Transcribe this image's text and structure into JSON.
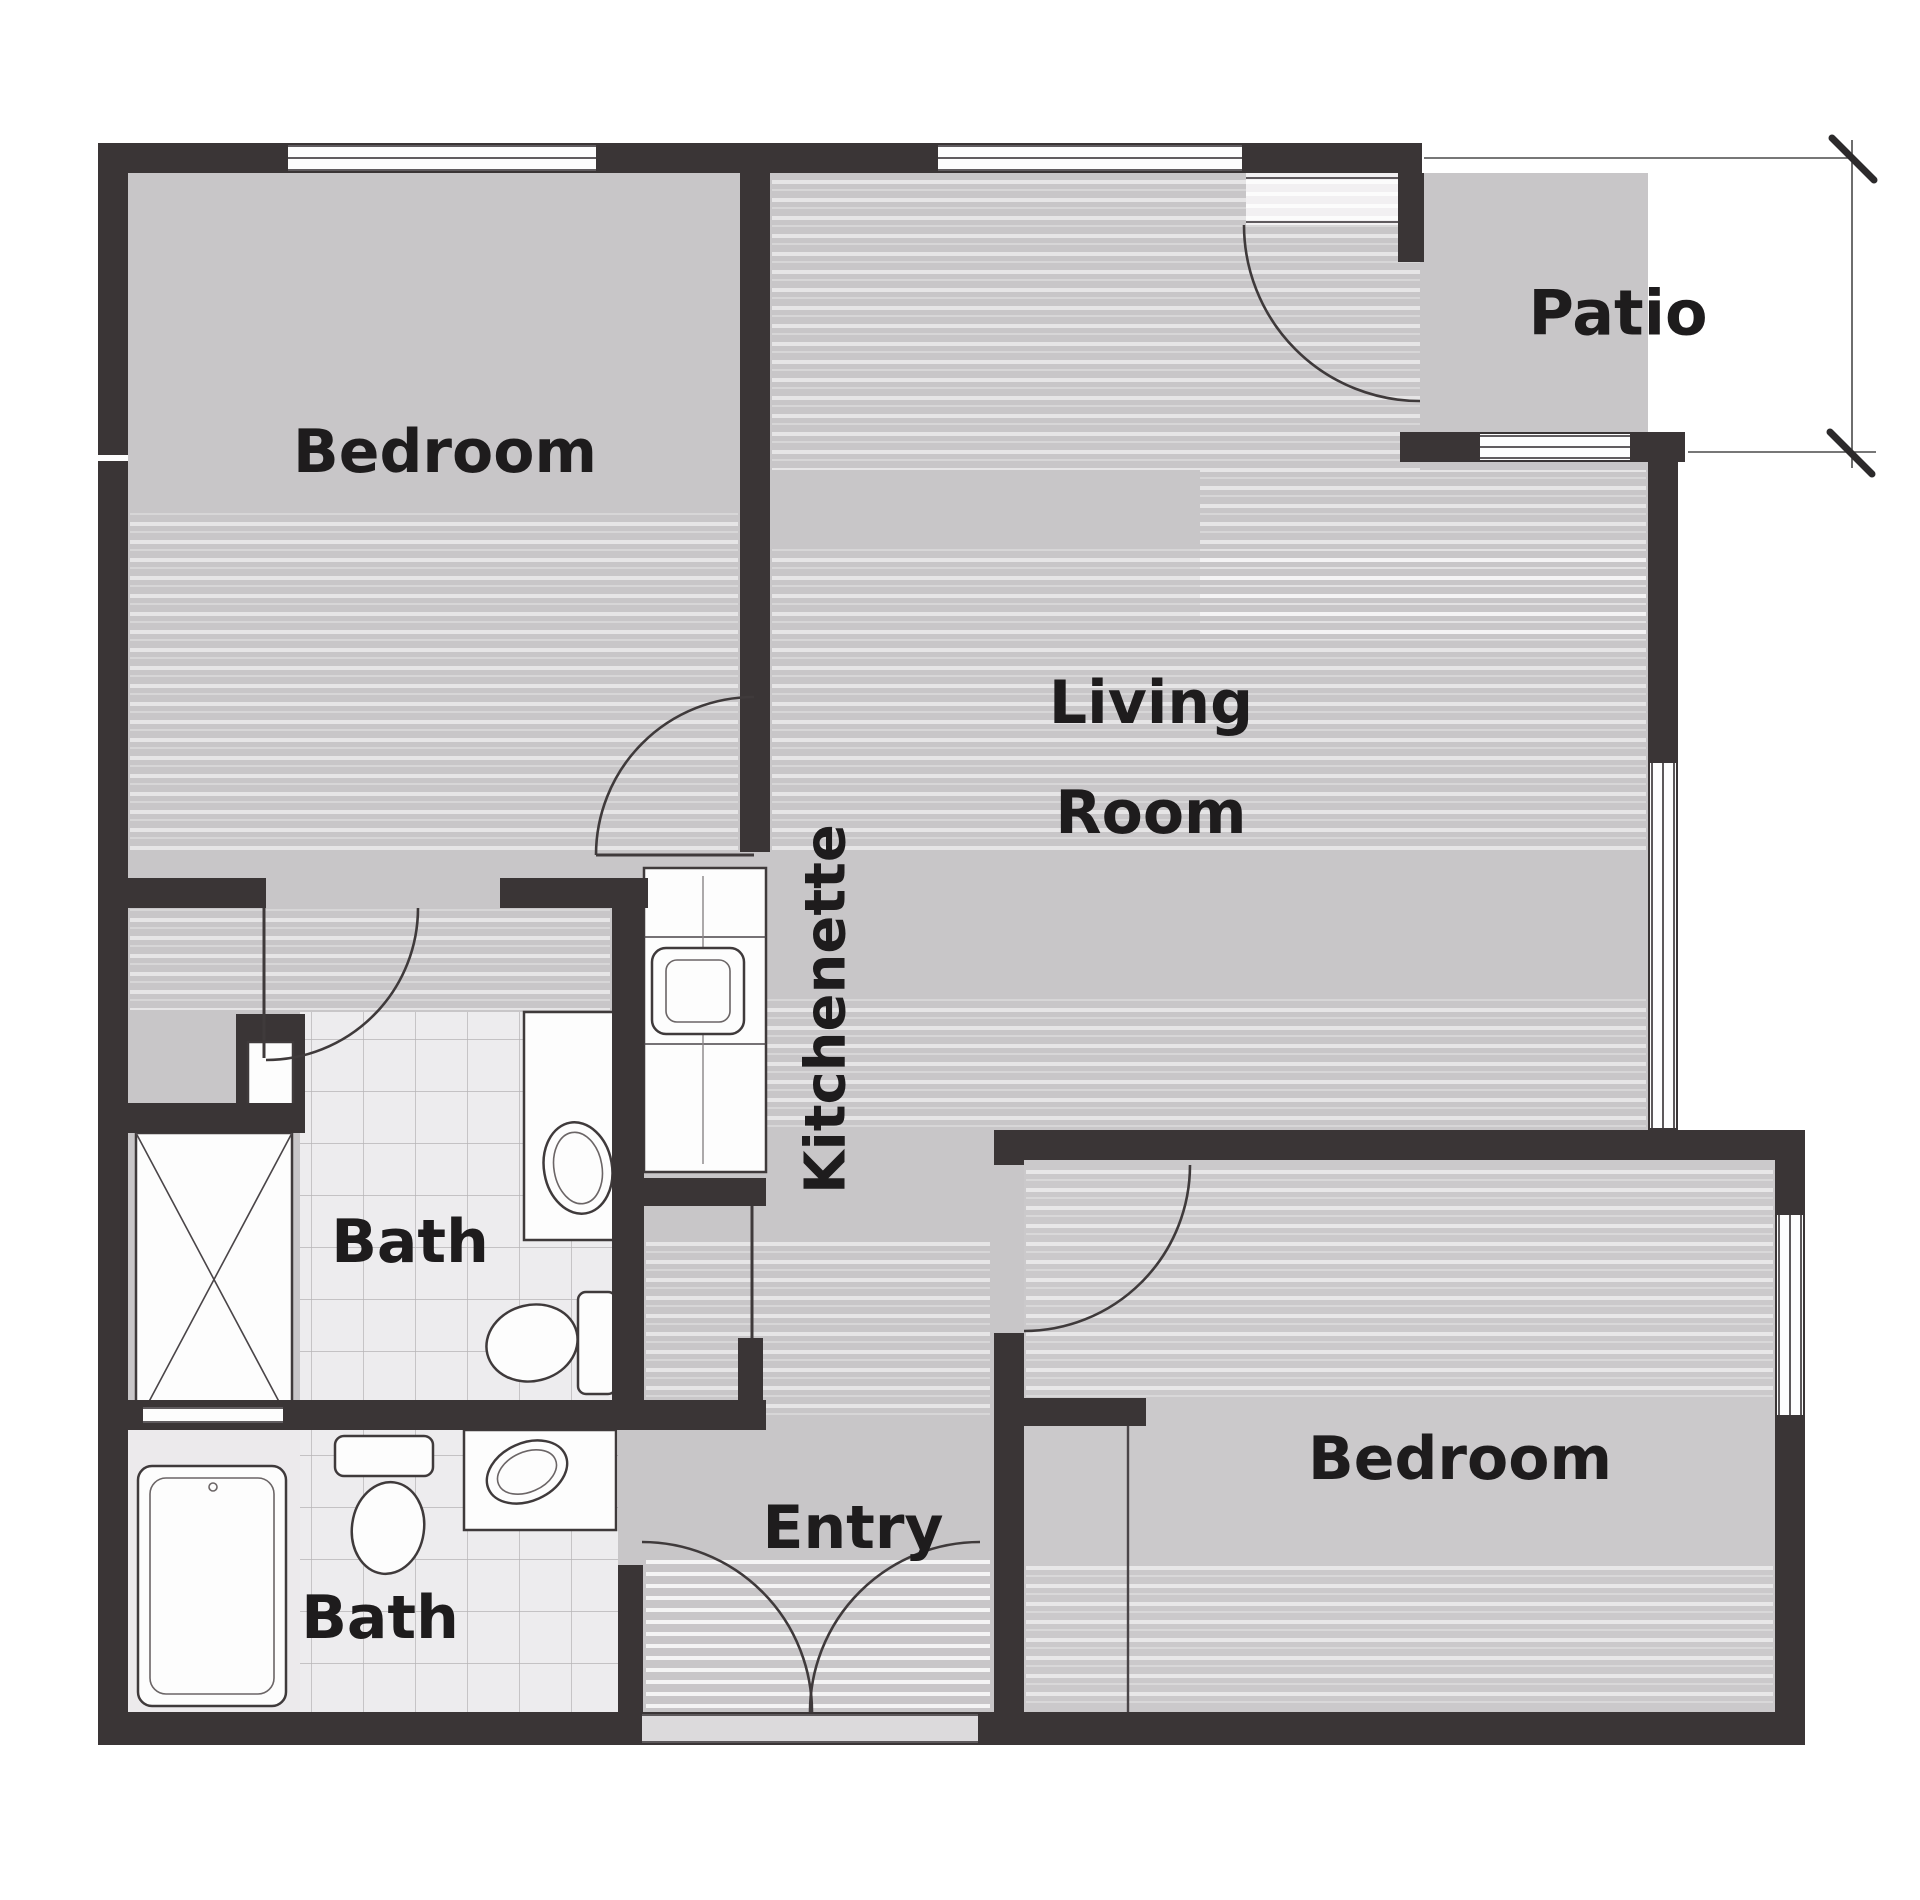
{
  "type": "floor-plan",
  "labels": {
    "bedroom_top_left": "Bedroom",
    "living_line1": "Living",
    "living_line2": "Room",
    "patio": "Patio",
    "kitchenette": "Kitchenette",
    "bath_upper": "Bath",
    "bath_lower": "Bath",
    "entry": "Entry",
    "bedroom_bottom_right": "Bedroom"
  },
  "rooms": [
    {
      "id": "bedroom-top-left",
      "label": "Bedroom"
    },
    {
      "id": "living-room",
      "label": "Living Room"
    },
    {
      "id": "patio",
      "label": "Patio"
    },
    {
      "id": "kitchenette",
      "label": "Kitchenette"
    },
    {
      "id": "bath-upper",
      "label": "Bath"
    },
    {
      "id": "bath-lower",
      "label": "Bath"
    },
    {
      "id": "entry",
      "label": "Entry"
    },
    {
      "id": "bedroom-bottom-right",
      "label": "Bedroom"
    }
  ],
  "fixtures": [
    "shower",
    "bathtub",
    "toilet-upper-bath",
    "sink-upper-bath",
    "toilet-lower-bath",
    "sink-lower-bath",
    "kitchen-counter",
    "kitchen-sink",
    "closet"
  ],
  "colors": {
    "wall": "#3a3536",
    "floor": "#c8c6c8",
    "floor_bedroom": "#cbc9cb",
    "tile": "#edecee",
    "tile_line": "#b6b4b6",
    "fixture_white": "#fdfdfd",
    "label_text": "#1e1c1d",
    "dimension_line": "#4a4a4a",
    "background": "#ffffff"
  }
}
